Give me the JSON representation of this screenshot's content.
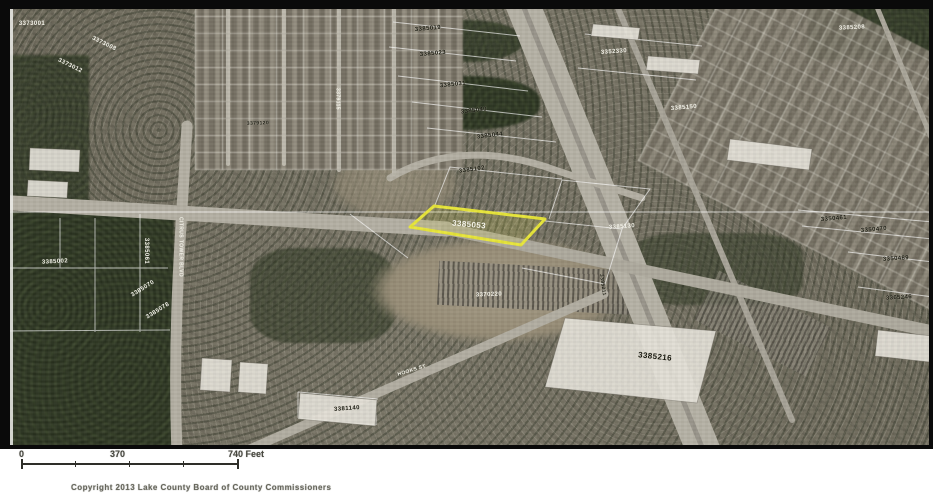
{
  "map": {
    "description": "Aerial parcel map with highlighted parcel",
    "frame_color": "#0a0a0a",
    "highlight": {
      "parcel_id": "3385053",
      "color": "#e8e63a"
    },
    "colors": {
      "vegetation": "#333c28",
      "road": "#b4b0a4",
      "parcel_line": "rgba(255,255,255,0.65)",
      "building_roof": "#e9e7e1"
    },
    "labels": [
      {
        "text": "3385053",
        "x": 469,
        "y": 225,
        "rot": 5,
        "c": "w",
        "size": 8,
        "type": "highlighted-parcel-label"
      },
      {
        "text": "3385216",
        "x": 655,
        "y": 357,
        "rot": 6,
        "c": "d",
        "size": 8,
        "type": "building-parcel-label"
      },
      {
        "text": "3385019",
        "x": 428,
        "y": 29,
        "rot": -5,
        "c": "d",
        "size": 6
      },
      {
        "text": "3385023",
        "x": 433,
        "y": 54,
        "rot": -5,
        "c": "d",
        "size": 6
      },
      {
        "text": "3385031",
        "x": 453,
        "y": 85,
        "rot": -6,
        "c": "d",
        "size": 6
      },
      {
        "text": "3385040",
        "x": 474,
        "y": 111,
        "rot": -7,
        "c": "d",
        "size": 6
      },
      {
        "text": "3385044",
        "x": 490,
        "y": 136,
        "rot": -7,
        "c": "d",
        "size": 6
      },
      {
        "text": "3352330",
        "x": 614,
        "y": 52,
        "rot": -4,
        "c": "w",
        "size": 6
      },
      {
        "text": "3385150",
        "x": 684,
        "y": 108,
        "rot": -5,
        "c": "w",
        "size": 6
      },
      {
        "text": "3385208",
        "x": 852,
        "y": 28,
        "rot": -3,
        "c": "w",
        "size": 6
      },
      {
        "text": "3350461",
        "x": 834,
        "y": 219,
        "rot": -5,
        "c": "d",
        "size": 6
      },
      {
        "text": "3350470",
        "x": 874,
        "y": 230,
        "rot": -5,
        "c": "d",
        "size": 6
      },
      {
        "text": "3350489",
        "x": 896,
        "y": 259,
        "rot": -4,
        "c": "d",
        "size": 6
      },
      {
        "text": "3365246",
        "x": 899,
        "y": 298,
        "rot": -3,
        "c": "d",
        "size": 6
      },
      {
        "text": "3385130",
        "x": 622,
        "y": 227,
        "rot": -4,
        "c": "w",
        "size": 6
      },
      {
        "text": "3385061",
        "x": 146,
        "y": 251,
        "rot": 90,
        "c": "w",
        "size": 6
      },
      {
        "text": "3385070",
        "x": 143,
        "y": 289,
        "rot": -32,
        "c": "w",
        "size": 6
      },
      {
        "text": "3385078",
        "x": 158,
        "y": 311,
        "rot": -32,
        "c": "w",
        "size": 6
      },
      {
        "text": "3385002",
        "x": 55,
        "y": 262,
        "rot": -3,
        "c": "w",
        "size": 6
      },
      {
        "text": "3381140",
        "x": 347,
        "y": 409,
        "rot": -4,
        "c": "d",
        "size": 6
      },
      {
        "text": "3370220",
        "x": 489,
        "y": 295,
        "rot": -2,
        "c": "w",
        "size": 6
      },
      {
        "text": "3385211",
        "x": 602,
        "y": 285,
        "rot": 82,
        "c": "d",
        "size": 5
      },
      {
        "text": "3385102",
        "x": 472,
        "y": 170,
        "rot": -8,
        "c": "d",
        "size": 6
      },
      {
        "text": "3373008",
        "x": 104,
        "y": 44,
        "rot": 26,
        "c": "w",
        "size": 6
      },
      {
        "text": "3373012",
        "x": 70,
        "y": 66,
        "rot": 26,
        "c": "w",
        "size": 6
      },
      {
        "text": "3373001",
        "x": 32,
        "y": 24,
        "rot": 0,
        "c": "w",
        "size": 6
      },
      {
        "text": "3379115",
        "x": 337,
        "y": 99,
        "rot": 90,
        "c": "w",
        "size": 5
      },
      {
        "text": "3379120",
        "x": 258,
        "y": 124,
        "rot": -2,
        "c": "d",
        "size": 5
      },
      {
        "text": "CITRUS TOWER BLVD",
        "x": 180,
        "y": 247,
        "rot": 90,
        "c": "w",
        "size": 5,
        "type": "road-label"
      },
      {
        "text": "HOOKS ST",
        "x": 412,
        "y": 371,
        "rot": -17,
        "c": "w",
        "size": 5,
        "type": "road-label"
      }
    ]
  },
  "scalebar": {
    "start": "0",
    "middle": "370",
    "end": "740 Feet"
  },
  "footer": {
    "copyright": "Copyright 2013 Lake County Board of County Commissioners"
  }
}
